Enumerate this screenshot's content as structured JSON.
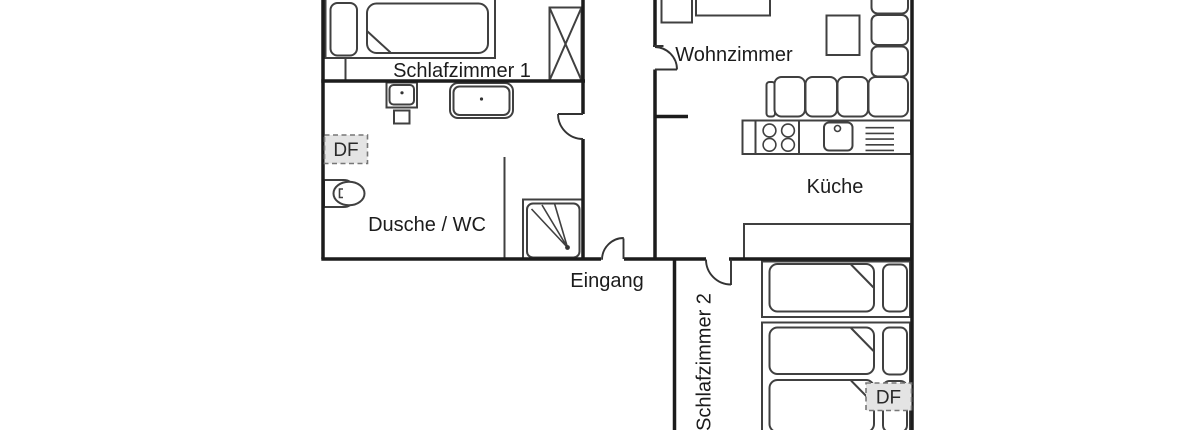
{
  "title": "Apartment floor plan (cropped)",
  "labels": {
    "bedroom1": "Schlafzimmer 1",
    "bedroom2": "Schlafzimmer 2",
    "living_room": "Wohnzimmer",
    "kitchen": "Küche",
    "bathroom": "Dusche / WC",
    "entrance": "Eingang",
    "roof_window_1": "DF",
    "roof_window_2": "DF"
  },
  "colors": {
    "background": "#ffffff",
    "wall_line": "#1c1c1c",
    "furniture_line": "#404040",
    "text": "#1c1c1c",
    "roof_window_fill": "#e4e4e4",
    "roof_window_border": "#777777"
  }
}
